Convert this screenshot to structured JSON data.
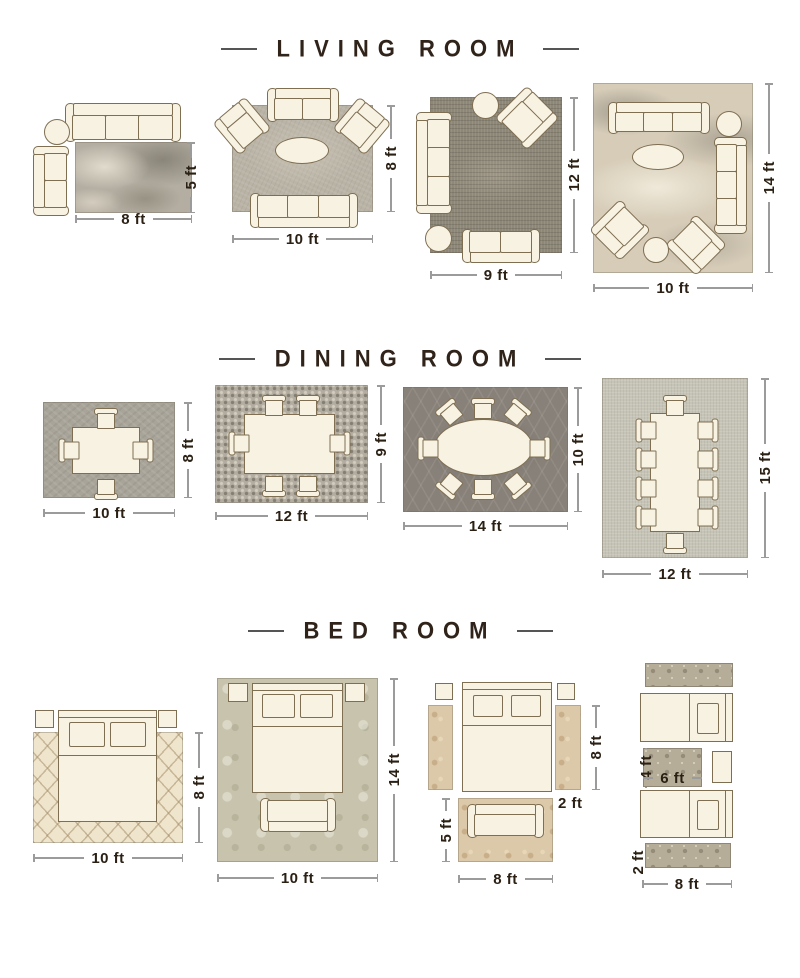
{
  "page": {
    "background": "#ffffff",
    "ink_color": "#2b2014",
    "accent_outline_color": "#7e6e52",
    "furniture_fill_color": "#f8f2e2",
    "dimension_line_color": "#9b9b9b"
  },
  "sections": [
    {
      "id": "living-room",
      "title": "LIVING ROOM",
      "layouts": [
        {
          "width_label": "8 ft",
          "height_label": "5 ft"
        },
        {
          "width_label": "10 ft",
          "height_label": "8 ft"
        },
        {
          "width_label": "9 ft",
          "height_label": "12 ft"
        },
        {
          "width_label": "10 ft",
          "height_label": "14 ft"
        }
      ]
    },
    {
      "id": "dining-room",
      "title": "DINING ROOM",
      "layouts": [
        {
          "width_label": "10 ft",
          "height_label": "8 ft"
        },
        {
          "width_label": "12 ft",
          "height_label": "9 ft"
        },
        {
          "width_label": "14 ft",
          "height_label": "10 ft"
        },
        {
          "width_label": "12 ft",
          "height_label": "15 ft"
        }
      ]
    },
    {
      "id": "bed-room",
      "title": "BED ROOM",
      "layouts": [
        {
          "width_label": "10 ft",
          "height_label": "8 ft"
        },
        {
          "width_label": "10 ft",
          "height_label": "14 ft"
        },
        {
          "width_label": "8 ft",
          "height_label": "5 ft",
          "runner_length_label": "8 ft",
          "runner_width_label": "2 ft"
        },
        {
          "width_label": "8 ft",
          "runner_width_label": "2 ft",
          "mat_width_label": "6 ft",
          "mat_height_label": "4 ft"
        }
      ]
    }
  ]
}
